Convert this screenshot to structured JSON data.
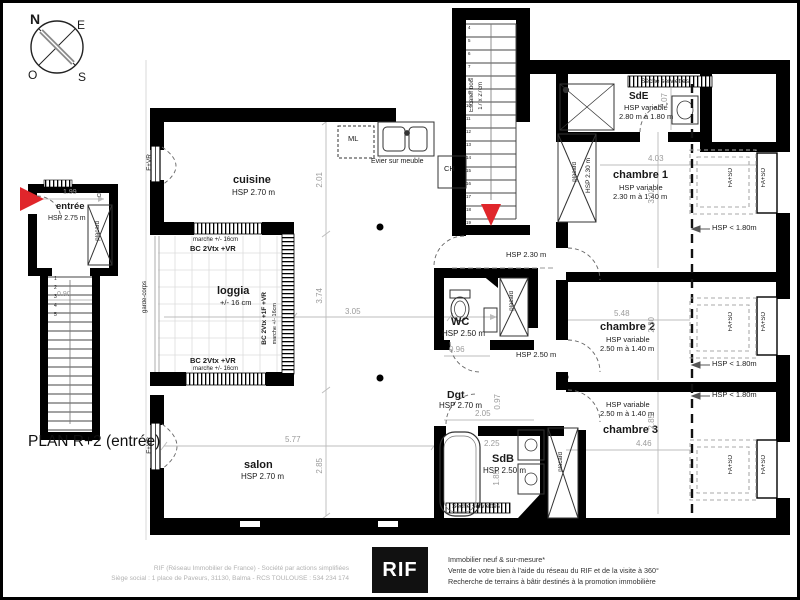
{
  "title": "PLAN R+2 (entrée)",
  "compass": {
    "n": "N",
    "e": "E",
    "o": "O",
    "s": "S"
  },
  "colors": {
    "red": "#e0262b",
    "wall": "#000000",
    "dim_gray": "#9b9b9b"
  },
  "entry_plan": {
    "room": "entrée",
    "hsp": "HSP 2.75 m",
    "dim_width": "1.99",
    "dim_stairs": "0.90",
    "placard": "placard",
    "ch": "CH",
    "steps": [
      "1",
      "2",
      "3",
      "4",
      "5"
    ]
  },
  "rooms": {
    "cuisine": {
      "name": "cuisine",
      "hsp": "HSP 2.70 m"
    },
    "salon": {
      "name": "salon",
      "hsp": "HSP 2.70 m"
    },
    "loggia": {
      "name": "loggia",
      "note": "+/- 16 cm"
    },
    "wc": {
      "name": "WC",
      "hsp": "HSP 2.50 m"
    },
    "dgt": {
      "name": "Dgt",
      "hsp": "HSP 2.70 m"
    },
    "sdb": {
      "name": "SdB",
      "hsp": "HSP 2.50 m"
    },
    "sde": {
      "name": "SdE",
      "hsp": "HSP variable",
      "range": "2.80 m à 1.80 m"
    },
    "chambre1": {
      "name": "chambre 1",
      "hsp": "HSP variable",
      "range": "2.30 m à 1.40 m"
    },
    "chambre2": {
      "name": "chambre 2",
      "hsp": "HSP variable",
      "range": "2.50 m à 1.40 m"
    },
    "chambre3": {
      "name": "chambre 3",
      "hsp": "HSP variable",
      "range": "2.50 m à 1.40 m"
    }
  },
  "labels": {
    "seche_serviettes": "Sèche serviettes",
    "evier": "Evier sur meuble",
    "ml": "ML",
    "ch": "CH",
    "escalier_line1": "Escalier bois",
    "escalier_line2": "17 x 27cm",
    "marche": "marche +/- 16cm",
    "bc_2vtx": "BC 2Vtx +VR",
    "bc_2vtx_1f": "BC 2Vtx +1F +VR",
    "f_vr": "F+VR",
    "fa_so": "FA+SO",
    "garde_corps": "garde-corps",
    "placard": "placard",
    "hsp_lt_180": "HSP < 1.80m",
    "hsp_230": "HSP 2.30 m",
    "hsp_250": "HSP 2.50 m"
  },
  "dimensions": {
    "cuisine_h": "2.01",
    "sejour_h": "3.74",
    "sejour_w": "3.05",
    "salon_w": "5.77",
    "salon_h": "2.85",
    "wc_door": "0.96",
    "dgt_w": "2.05",
    "dgt_h": "0.97",
    "sdb_w": "2.25",
    "sdb_h": "1.85",
    "sde_h": "1.07",
    "ch1_w": "4.03",
    "ch1_h": "3.02",
    "ch2_w": "5.48",
    "ch2_h": "2.30",
    "ch3_w": "4.46",
    "ch3_h": "2.85"
  },
  "main_steps": [
    "4",
    "5",
    "6",
    "7",
    "8",
    "9",
    "10",
    "11",
    "12",
    "13",
    "14",
    "15",
    "16",
    "17",
    "18",
    "19"
  ],
  "footer": {
    "legal_line1": "RIF (Réseau Immobilier de France) - Société par actions simplifiées",
    "legal_line2": "Siège social : 1 place de Paveurs, 31130, Balma - RCS TOULOUSE : 534 234 174",
    "logo": "RIF",
    "services_line1": "Immobilier neuf & sur-mesure*",
    "services_line2": "Vente de votre bien à l'aide du réseau du RIF et de la visite à 360°",
    "services_line3": "Recherche de terrains à bâtir destinés à la promotion immobilière"
  }
}
